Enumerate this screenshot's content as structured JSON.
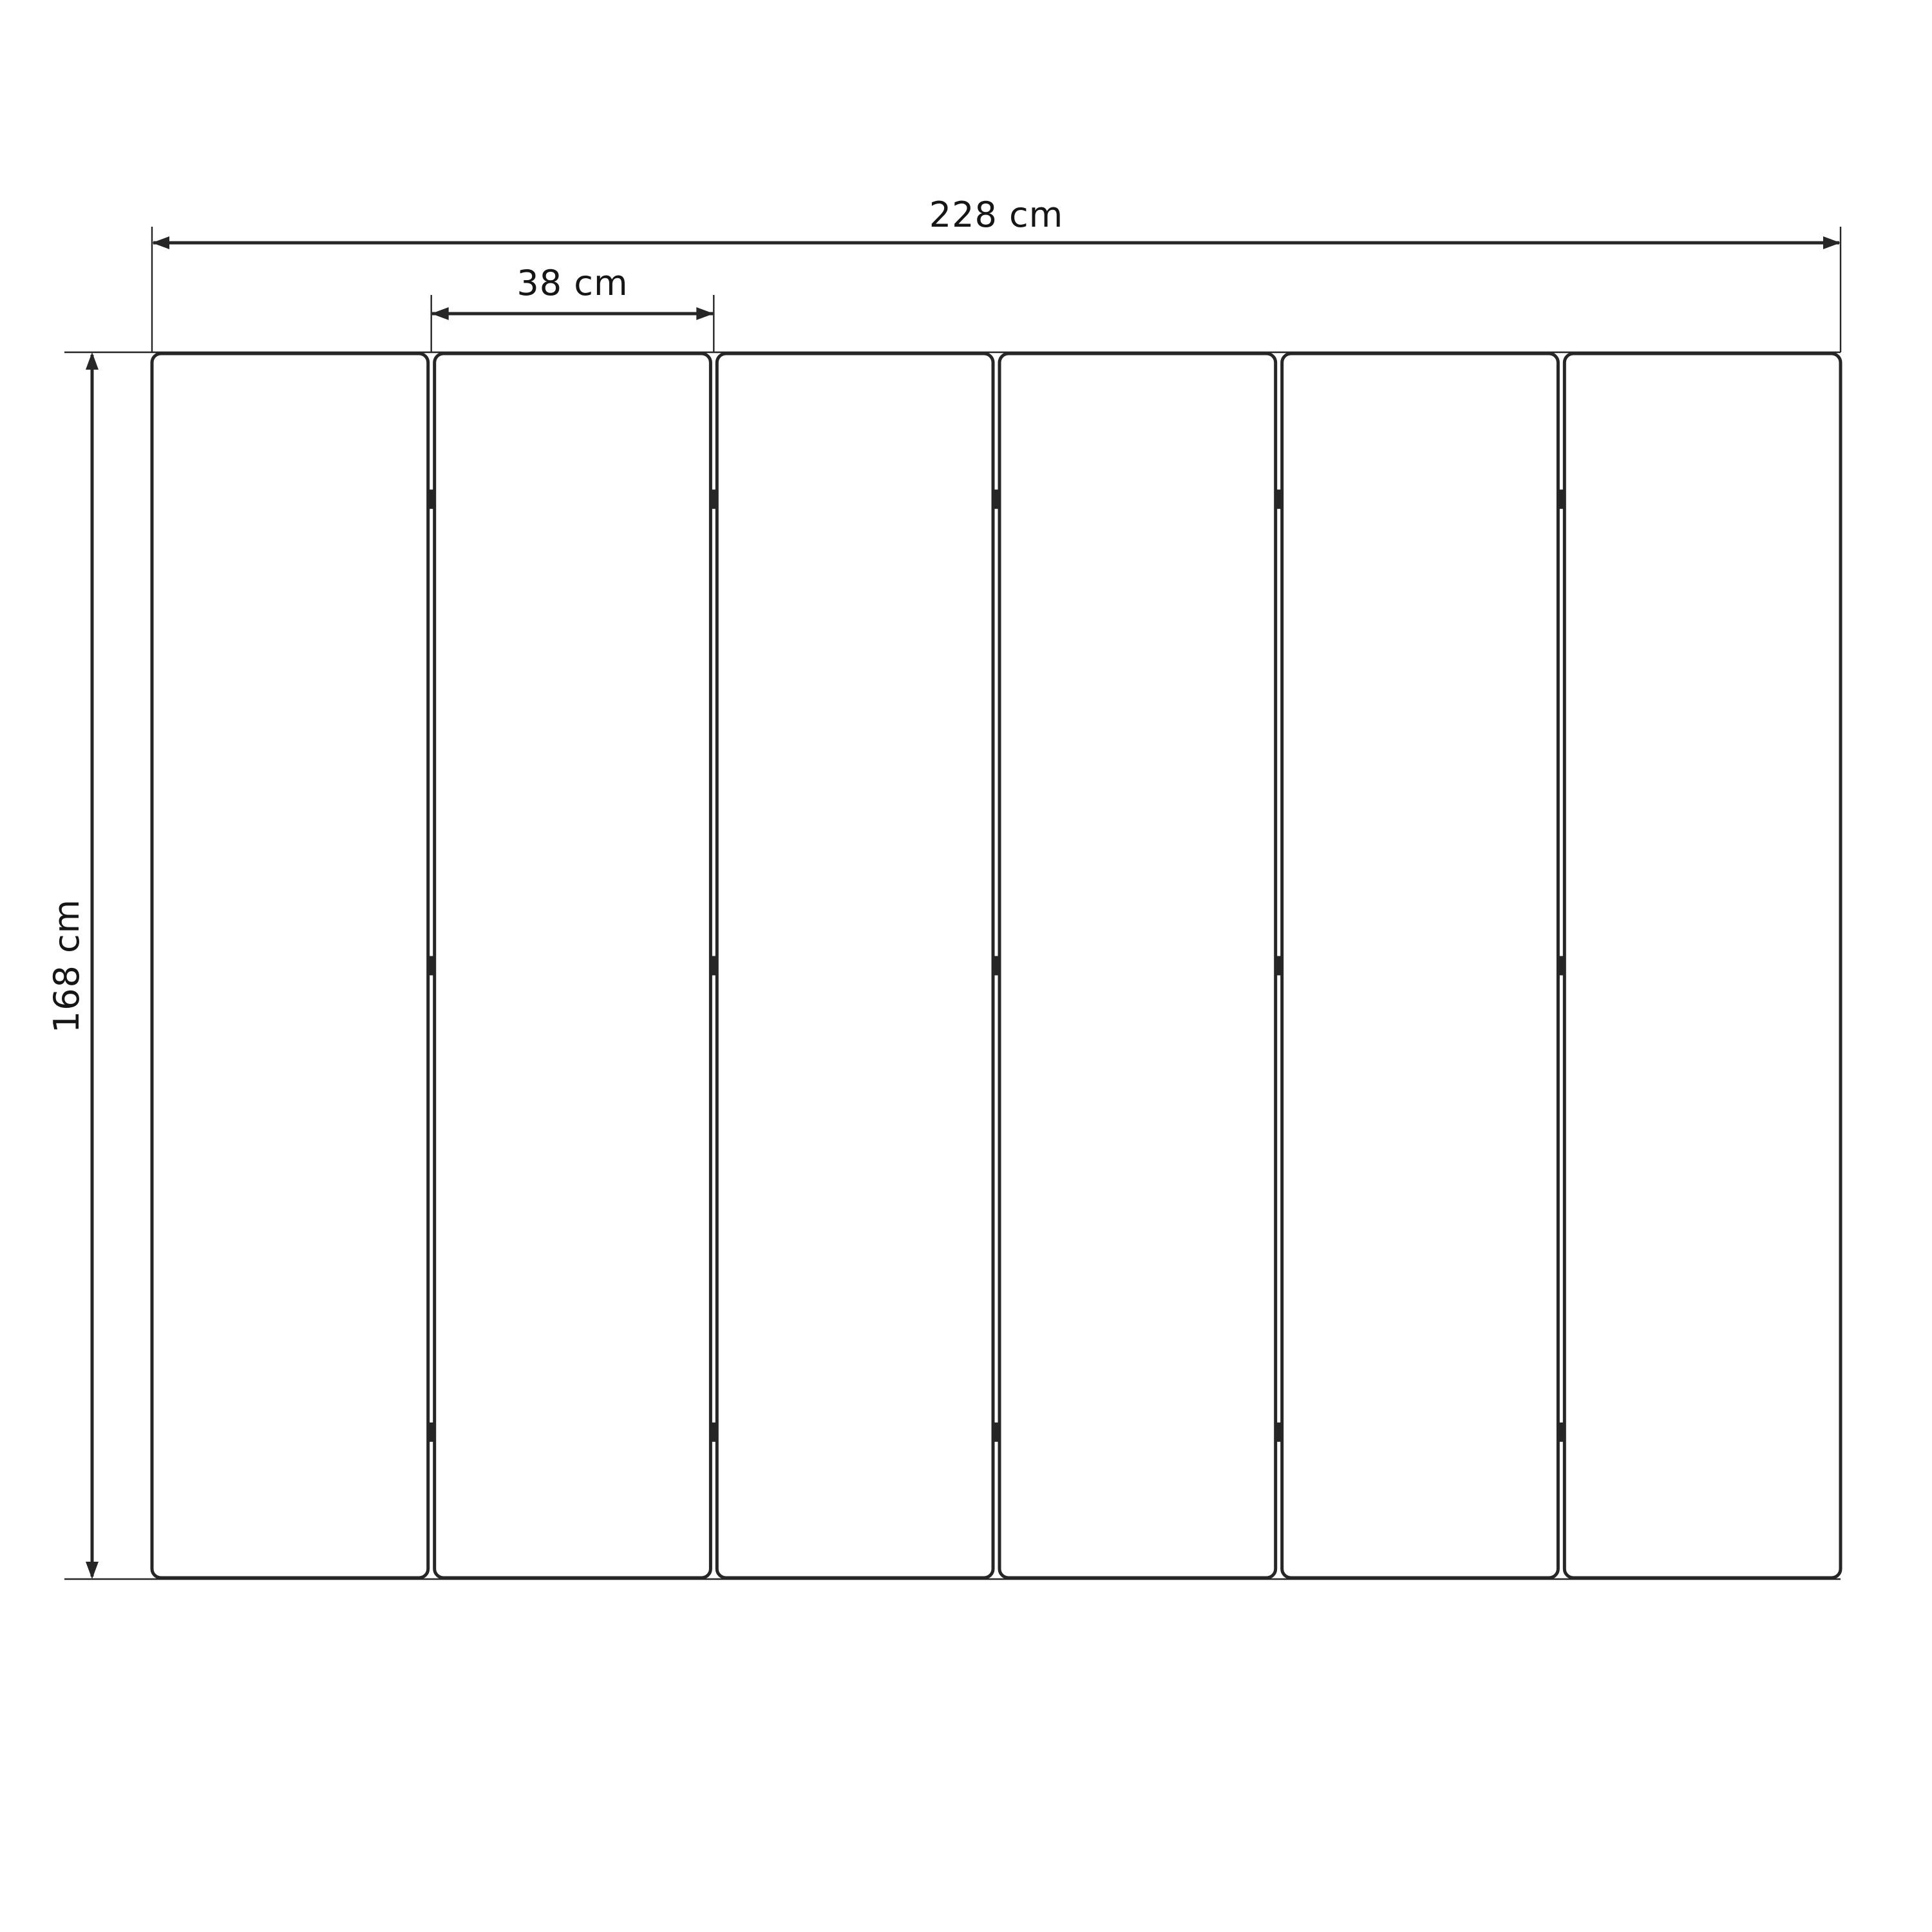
{
  "page": {
    "background": "#ffffff"
  },
  "diagram": {
    "line_color": "#262626",
    "text_color": "#161616",
    "panel": {
      "count": 6,
      "fill": "#ffffff"
    },
    "hinges": {
      "per_seam": 3,
      "position_fractions": [
        0.119,
        0.5,
        0.881
      ]
    },
    "dimensions": {
      "total_width": {
        "label": "228 cm",
        "value": 228,
        "unit": "cm"
      },
      "panel_width": {
        "label": "38 cm",
        "value": 38,
        "unit": "cm"
      },
      "height": {
        "label": "168 cm",
        "value": 168,
        "unit": "cm"
      }
    }
  }
}
